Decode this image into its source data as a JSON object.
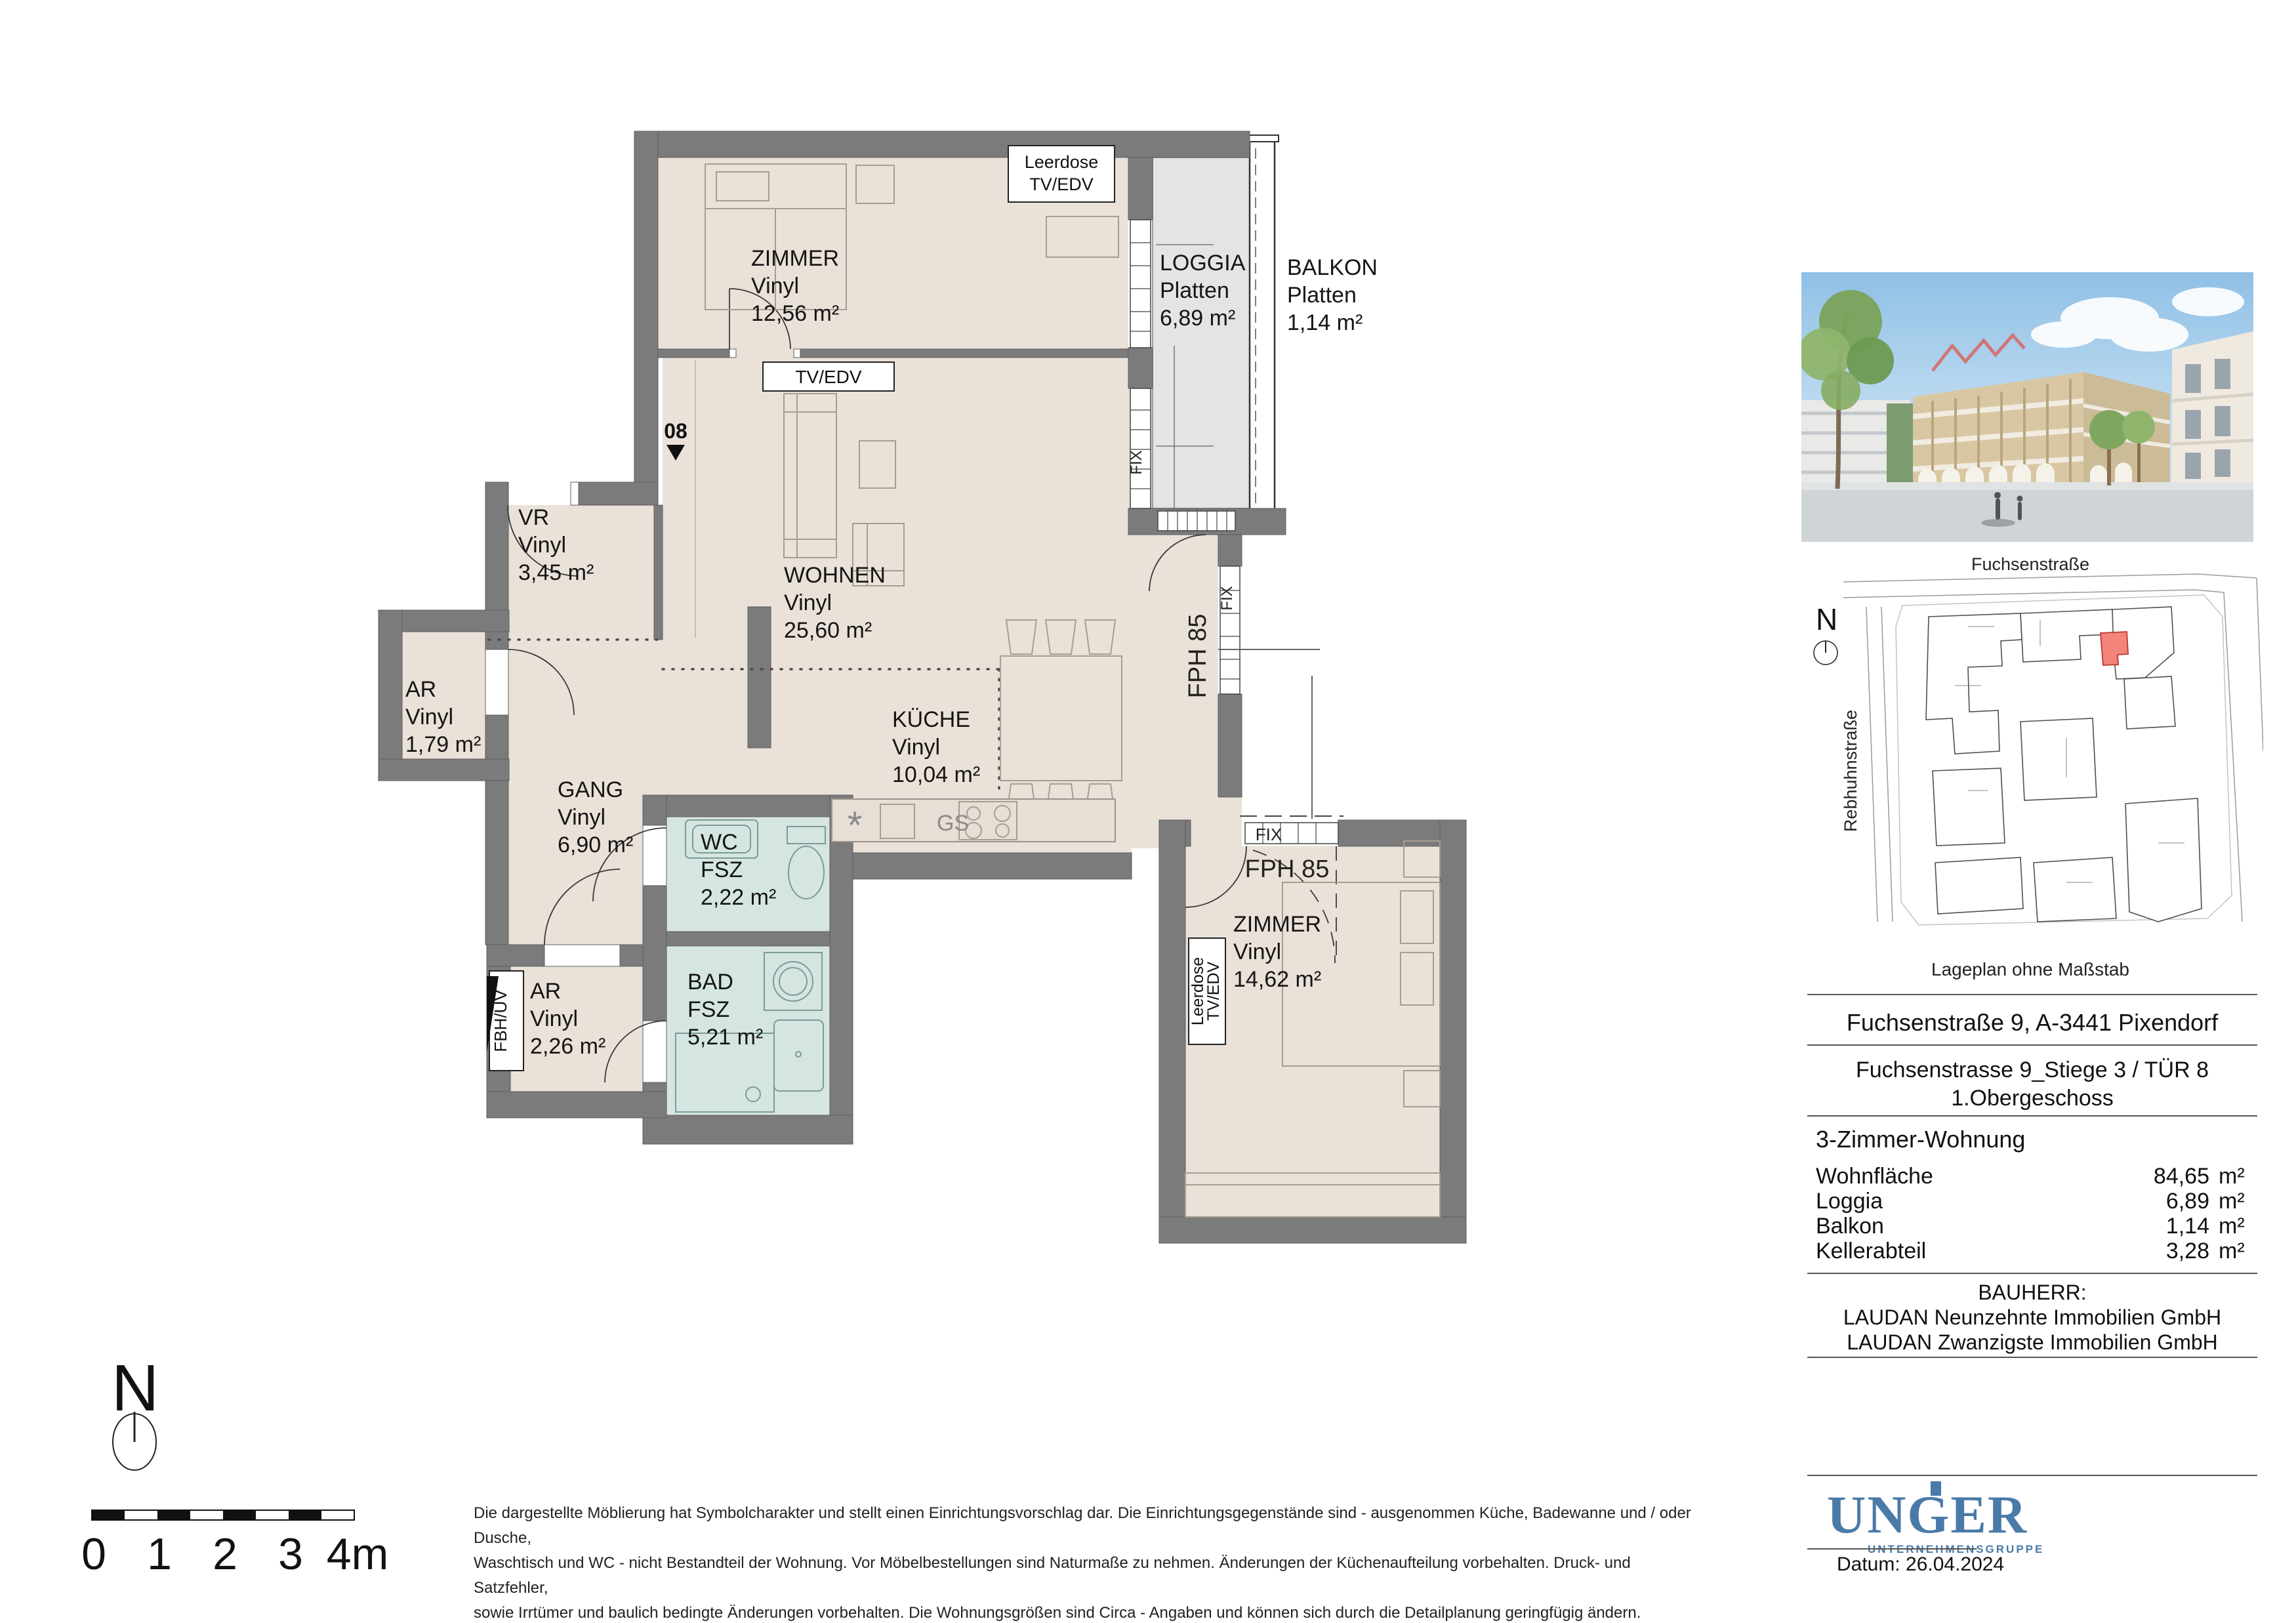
{
  "plan": {
    "unit_marker": "08",
    "rooms": {
      "zimmer1": {
        "name": "ZIMMER",
        "floor": "Vinyl",
        "area": "12,56 m²"
      },
      "loggia": {
        "name": "LOGGIA",
        "floor": "Platten",
        "area": "6,89 m²"
      },
      "balkon": {
        "name": "BALKON",
        "floor": "Platten",
        "area": "1,14 m²"
      },
      "vr": {
        "name": "VR",
        "floor": "Vinyl",
        "area": "3,45 m²"
      },
      "ar1": {
        "name": "AR",
        "floor": "Vinyl",
        "area": "1,79 m²"
      },
      "gang": {
        "name": "GANG",
        "floor": "Vinyl",
        "area": "6,90 m²"
      },
      "wohnen": {
        "name": "WOHNEN",
        "floor": "Vinyl",
        "area": "25,60 m²"
      },
      "kueche": {
        "name": "KÜCHE",
        "floor": "Vinyl",
        "area": "10,04 m²"
      },
      "wc": {
        "name": "WC",
        "floor": "FSZ",
        "area": "2,22 m²"
      },
      "bad": {
        "name": "BAD",
        "floor": "FSZ",
        "area": "5,21 m²"
      },
      "ar2": {
        "name": "AR",
        "floor": "Vinyl",
        "area": "2,26 m²"
      },
      "zimmer2": {
        "name": "ZIMMER",
        "floor": "Vinyl",
        "area": "14,62 m²"
      }
    },
    "annotations": {
      "leerdose_1": "Leerdose",
      "leerdose_2": "TV/EDV",
      "tvedv": "TV/EDV",
      "fix": "FIX",
      "fph85": "FPH 85",
      "gs": "GS",
      "star": "*",
      "fbhuv": "FBH/UV"
    },
    "compass": "N",
    "scale": {
      "t0": "0",
      "t1": "1",
      "t2": "2",
      "t3": "3",
      "t4": "4m"
    }
  },
  "site_plan": {
    "street_top": "Fuchsenstraße",
    "street_left": "Rebhuhnstraße",
    "caption": "Lageplan ohne Maßstab",
    "compass": "N"
  },
  "info": {
    "address": "Fuchsenstraße 9, A-3441 Pixendorf",
    "unit_line1": "Fuchsenstrasse 9_Stiege 3 / TÜR 8",
    "unit_line2": "1.Obergeschoss",
    "apartment_type": "3-Zimmer-Wohnung",
    "areas": [
      {
        "label": "Wohnfläche",
        "value": "84,65",
        "unit": "m²"
      },
      {
        "label": "Loggia",
        "value": "6,89",
        "unit": "m²"
      },
      {
        "label": "Balkon",
        "value": "1,14",
        "unit": "m²"
      },
      {
        "label": "Kellerabteil",
        "value": "3,28",
        "unit": "m²"
      }
    ],
    "bauherr_label": "BAUHERR:",
    "bauherr_line1": "LAUDAN Neunzehnte Immobilien GmbH",
    "bauherr_line2": "LAUDAN Zwanzigste Immobilien GmbH",
    "logo": {
      "name": "UNGER",
      "subtitle": "UNTERNEHMENSGRUPPE"
    },
    "date": "Datum: 26.04.2024"
  },
  "disclaimer": {
    "line1": "Die dargestellte Möblierung hat Symbolcharakter und stellt einen Einrichtungsvorschlag dar. Die Einrichtungsgegenstände sind - ausgenommen Küche, Badewanne und / oder Dusche,",
    "line2": "Waschtisch und WC - nicht Bestandteil der Wohnung. Vor Möbelbestellungen sind Naturmaße zu nehmen. Änderungen der Küchenaufteilung vorbehalten. Druck- und Satzfehler,",
    "line3": "sowie Irrtümer und baulich bedingte Änderungen vorbehalten. Die Wohnungsgrößen sind Circa - Angaben und können sich durch die Detailplanung geringfügig ändern.",
    "line4": "Maßgeblich ist in jedem Fall der Mietvertrag."
  },
  "colors": {
    "wall": "#7b7b7b",
    "floor": "#eae1d9",
    "wet": "#d5e6e2",
    "loggia": "#e4e4e4",
    "accent_red": "#f2847c",
    "logo_blue": "#4a7aa8"
  }
}
